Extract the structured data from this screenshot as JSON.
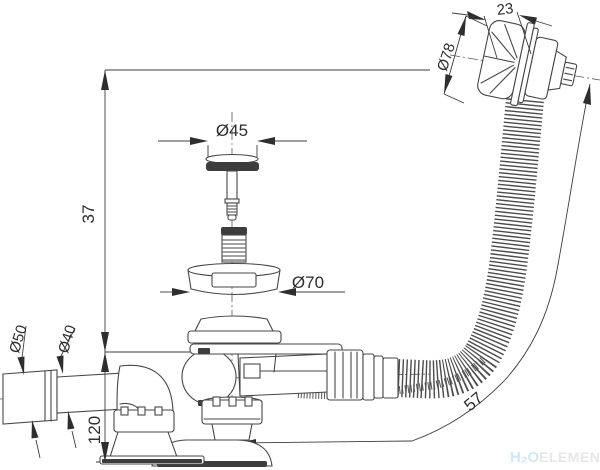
{
  "drawing": {
    "title": "bath-drain-overflow-siphon-technical-drawing",
    "dimensions": {
      "overflow_width": "23",
      "overflow_diameter": "Ø78",
      "stopper_diameter": "Ø45",
      "flange_diameter": "Ø70",
      "pipe_outer_diameter": "Ø50",
      "pipe_inner_diameter": "Ø40",
      "height_overflow_to_tub": "37",
      "height_trap": "120",
      "hose_length": "57"
    },
    "watermark": {
      "h2o": "H₂O",
      "element": "ELEMENT"
    },
    "colors": {
      "line": "#474747",
      "dimension": "#2e2e2e",
      "watermark_h2o": "#cfe9f4",
      "watermark_element": "#e7e7e7"
    }
  }
}
